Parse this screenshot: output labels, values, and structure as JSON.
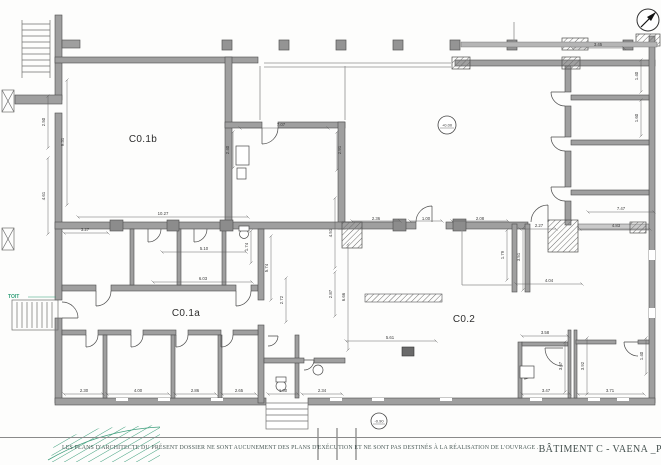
{
  "footer": {
    "disclaimer": "LES PLANS D'ARCHITECTE DU PRÉSENT DOSSIER NE SONT AUCUNEMENT DES PLANS D'EXÉCUTION ET NE SONT PAS DESTINÉS À LA RÉALISATION DE L'OUVRAGE .",
    "title": "BÂTIMENT C - VAENA _PLAN RDC - ECH 1/100",
    "page_number": "24"
  },
  "plan": {
    "room_labels": [
      {
        "t": "C0.1b",
        "x": 143,
        "y": 142
      },
      {
        "t": "C0.1a",
        "x": 186,
        "y": 316
      },
      {
        "t": "C0.2",
        "x": 464,
        "y": 322
      }
    ],
    "elevation_markers": [
      {
        "t": "+0.00",
        "x": 447,
        "y": 125,
        "rad": 9
      },
      {
        "t": "-0.90",
        "x": 379,
        "y": 421,
        "rad": 8
      }
    ],
    "annotations": [
      {
        "t": "TOIT",
        "x": 8,
        "y": 298
      }
    ],
    "dimensions": [
      {
        "t": "7.07",
        "x": 281,
        "y": 126,
        "l": [
          240,
          128,
          328,
          128
        ]
      },
      {
        "t": "2.40",
        "x": 229,
        "y": 150,
        "r": 1,
        "l": [
          233,
          132,
          233,
          168
        ]
      },
      {
        "t": "2.91",
        "x": 341,
        "y": 150,
        "r": 1,
        "l": [
          337,
          132,
          337,
          170
        ]
      },
      {
        "t": "9.31",
        "x": 64,
        "y": 142,
        "r": 1,
        "l": [
          67,
          80,
          67,
          205
        ]
      },
      {
        "t": "2.50",
        "x": 45,
        "y": 122,
        "r": 1,
        "l": [
          48,
          96,
          48,
          148
        ]
      },
      {
        "t": "4.61",
        "x": 45,
        "y": 196,
        "r": 1,
        "l": [
          48,
          158,
          48,
          234
        ]
      },
      {
        "t": "10.27",
        "x": 163,
        "y": 215,
        "l": [
          78,
          217,
          248,
          217
        ]
      },
      {
        "t": "3.27",
        "x": 85,
        "y": 231,
        "l": [
          64,
          233,
          108,
          233
        ]
      },
      {
        "t": "5.10",
        "x": 204,
        "y": 250,
        "l": [
          162,
          252,
          246,
          252
        ]
      },
      {
        "t": "6.03",
        "x": 203,
        "y": 280,
        "l": [
          153,
          282,
          252,
          282
        ]
      },
      {
        "t": "1.74",
        "x": 248,
        "y": 247,
        "r": 1,
        "l": [
          251,
          231,
          251,
          263
        ]
      },
      {
        "t": "5.74",
        "x": 268,
        "y": 268,
        "r": 1,
        "l": [
          271,
          236,
          271,
          300
        ]
      },
      {
        "t": "2.72",
        "x": 283,
        "y": 300,
        "r": 1,
        "l": [
          286,
          278,
          286,
          322
        ]
      },
      {
        "t": "4.51",
        "x": 332,
        "y": 233,
        "r": 1,
        "l": [
          335,
          198,
          335,
          268
        ]
      },
      {
        "t": "2.87",
        "x": 332,
        "y": 294,
        "r": 1,
        "l": [
          335,
          272,
          335,
          316
        ]
      },
      {
        "t": "6.66",
        "x": 345,
        "y": 297,
        "r": 1,
        "l": [
          348,
          244,
          348,
          350
        ]
      },
      {
        "t": "2.36",
        "x": 376,
        "y": 220,
        "l": [
          352,
          221,
          400,
          221
        ]
      },
      {
        "t": "1.00",
        "x": 426,
        "y": 220,
        "l": [
          410,
          221,
          442,
          221
        ]
      },
      {
        "t": "2.08",
        "x": 480,
        "y": 220,
        "l": [
          452,
          221,
          508,
          221
        ]
      },
      {
        "t": "1.79",
        "x": 504,
        "y": 255,
        "r": 1,
        "l": [
          507,
          230,
          507,
          280
        ]
      },
      {
        "t": "3.51",
        "x": 520,
        "y": 257,
        "r": 1,
        "l": [
          523,
          228,
          523,
          290
        ]
      },
      {
        "t": "4.04",
        "x": 549,
        "y": 282,
        "l": [
          516,
          284,
          582,
          284
        ]
      },
      {
        "t": "5.61",
        "x": 390,
        "y": 339,
        "l": [
          346,
          341,
          436,
          341
        ]
      },
      {
        "t": "2.27",
        "x": 539,
        "y": 227,
        "l": [
          520,
          229,
          556,
          229
        ]
      },
      {
        "t": "7.47",
        "x": 621,
        "y": 210,
        "l": [
          588,
          212,
          654,
          212
        ]
      },
      {
        "t": "4.83",
        "x": 616,
        "y": 227,
        "l": [
          580,
          229,
          650,
          229
        ]
      },
      {
        "t": "3.45",
        "x": 598,
        "y": 46,
        "l": [
          572,
          48,
          624,
          48
        ]
      },
      {
        "t": "1.40",
        "x": 638,
        "y": 76,
        "r": 1,
        "l": [
          641,
          60,
          641,
          92
        ]
      },
      {
        "t": "1.60",
        "x": 638,
        "y": 118,
        "r": 1,
        "l": [
          641,
          100,
          641,
          136
        ]
      },
      {
        "t": "2.30",
        "x": 84,
        "y": 392,
        "l": [
          64,
          394,
          103,
          394
        ]
      },
      {
        "t": "4.00",
        "x": 138,
        "y": 392,
        "l": [
          107,
          394,
          169,
          394
        ]
      },
      {
        "t": "2.86",
        "x": 195,
        "y": 392,
        "l": [
          175,
          394,
          216,
          394
        ]
      },
      {
        "t": "2.65",
        "x": 239,
        "y": 392,
        "l": [
          222,
          394,
          256,
          394
        ]
      },
      {
        "t": "1.00",
        "x": 283,
        "y": 392,
        "l": [
          268,
          394,
          298,
          394
        ]
      },
      {
        "t": "2.34",
        "x": 322,
        "y": 392,
        "l": [
          302,
          394,
          342,
          394
        ]
      },
      {
        "t": "3.58",
        "x": 545,
        "y": 334,
        "l": [
          522,
          336,
          568,
          336
        ]
      },
      {
        "t": "3.47",
        "x": 546,
        "y": 392,
        "l": [
          522,
          394,
          570,
          394
        ]
      },
      {
        "t": "3.71",
        "x": 610,
        "y": 392,
        "l": [
          578,
          394,
          644,
          394
        ]
      },
      {
        "t": "3.67",
        "x": 562,
        "y": 366,
        "r": 1,
        "l": [
          565,
          342,
          565,
          392
        ]
      },
      {
        "t": "3.92",
        "x": 584,
        "y": 366,
        "r": 1,
        "l": [
          587,
          338,
          587,
          394
        ]
      },
      {
        "t": "1.40",
        "x": 643,
        "y": 356,
        "r": 1,
        "l": [
          646,
          338,
          646,
          374
        ]
      }
    ],
    "colors": {
      "wall": "#9f9f9f",
      "wall_stroke": "#4d4d4d",
      "dim_line": "#5a5a5a",
      "green": "#2e9e77"
    }
  }
}
